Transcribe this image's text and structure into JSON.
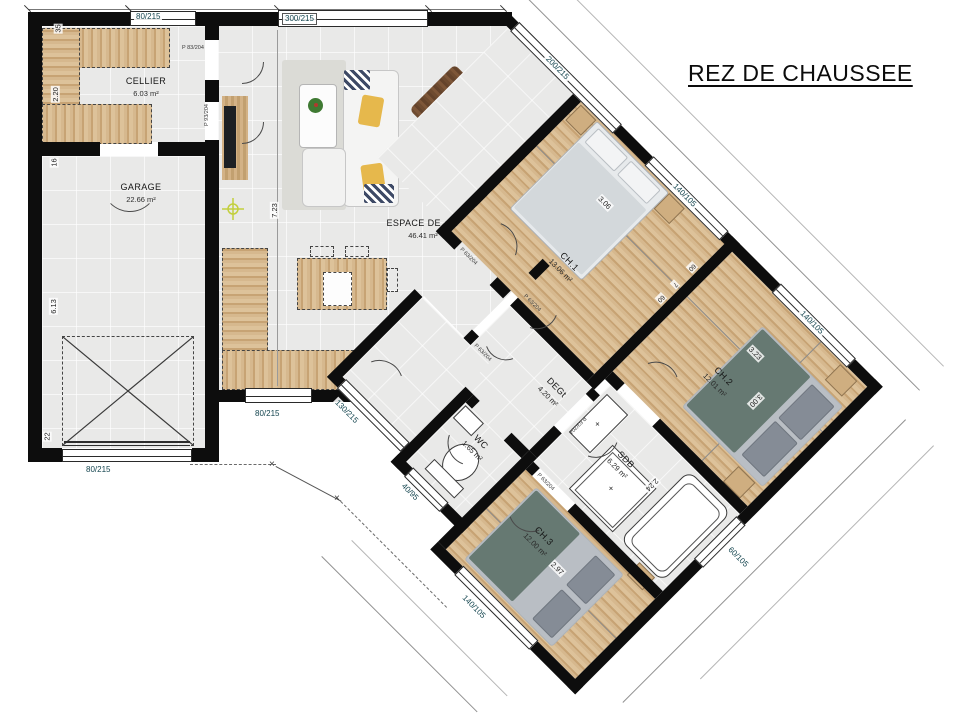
{
  "title": "REZ DE CHAUSSEE",
  "rooms": {
    "cellier": {
      "name": "CELLIER",
      "area": "6.03 m²"
    },
    "garage": {
      "name": "GARAGE",
      "area": "22.66 m²"
    },
    "espace_de_vie": {
      "name": "ESPACE DE VIE",
      "area": "46.41 m²"
    },
    "ch1": {
      "name": "CH.1",
      "area": "13.06 m²"
    },
    "ch2": {
      "name": "CH.2",
      "area": "12.01 m²"
    },
    "ch3": {
      "name": "CH.3",
      "area": "12.00 m²"
    },
    "degt": {
      "name": "DEGt",
      "area": "4.20 m²"
    },
    "wc": {
      "name": "WC",
      "area": "1.65 m²"
    },
    "sdb": {
      "name": "SDB",
      "area": "6.29 m²"
    }
  },
  "windows": {
    "cellier_top": "80/215",
    "living_top": "300/215",
    "living_diag": "200/215",
    "ch1": "140/105",
    "ch2": "140/105",
    "ch3": "140/105",
    "sdb": "60/105",
    "living_bottom": "80/215",
    "garage_door": "80/215",
    "entry_door": "130/215",
    "wc": "40/95"
  },
  "doors": {
    "cellier_ext": "P 83/204",
    "cellier_living": "P 93/204",
    "ch1": "P 63/204",
    "hall_double_left": "P 63/204",
    "hall_double_right": "P 63/204",
    "sdb": "P 63/204",
    "ch3": "P 63/204"
  },
  "dimensions": {
    "left_35": "35",
    "left_220": "2.20",
    "left_16": "16",
    "left_613": "6.13",
    "left_22": "22",
    "living_723": "7.23",
    "ch1_306": "3.06",
    "ch2_323": "3.23",
    "ch2_300": "3.00",
    "sdb_224": "2.24",
    "ch3_297": "2.97",
    "niche_60a": "60",
    "niche_7": "7",
    "niche_60b": "60"
  },
  "colors": {
    "wall": "#0d0d0d",
    "wood": "#cfa87b",
    "floor": "#e9e9e8",
    "window_label": "#14454f",
    "crosshair": "#c3cf3d"
  }
}
